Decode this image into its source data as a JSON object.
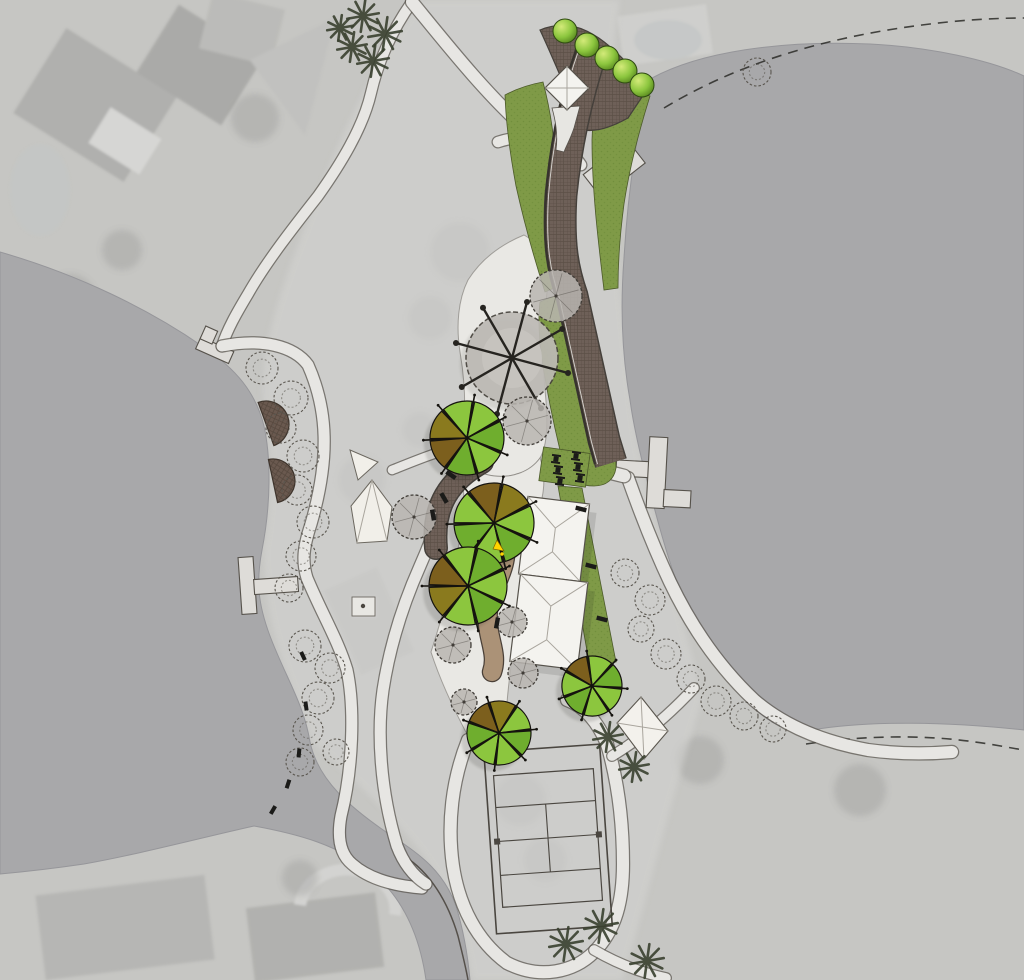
{
  "title": "lakeside-park-master-plan-aerial-overlay",
  "colors": {
    "land": "#c6c6c3",
    "parkLight": "#d3d3d0",
    "water": "#a8a8aa",
    "waterEdge": "#96969a",
    "pathFill": "#e7e6e3",
    "pathEdge": "#57524c",
    "apron": "#e9e8e4",
    "lawn": "#7f9a47",
    "lawnDot": "#718e3c",
    "promenade": "#6e6058",
    "promenadeLine": "#5c5047",
    "curb": "#37332e",
    "deck": "#6a594f",
    "deckLine": "#54463c",
    "tan": "#ab9277",
    "tanEdge": "#4a4038",
    "treeGreen": "#8cc63e",
    "treeGreen2": "#6fae2e",
    "treeOlive": "#8a7a1e",
    "treeBrown": "#7c5f1d",
    "treeOutline": "#15130f",
    "canopy": "#b8b5b0",
    "canopyEdge": "#413d38",
    "hedgeEdge": "#2f4a12",
    "building": "#f4f3ef",
    "buildingEdge": "#56524b",
    "ridge": "#a9a59d",
    "dock": "#dedcd8",
    "white": "#f1efe9",
    "palm": "#39402f",
    "black": "#1b1b19",
    "yellow": "#ffd400",
    "ghost": "#9a9a98"
  },
  "features": {
    "design_trees": [
      {
        "cx": 467,
        "cy": 438,
        "r": 37,
        "rot": 10,
        "c": [
          "g",
          "g2",
          "g",
          "g2",
          "b",
          "o",
          "g"
        ]
      },
      {
        "cx": 494,
        "cy": 523,
        "r": 40,
        "rot": -40,
        "c": [
          "b",
          "o",
          "g",
          "g2",
          "g",
          "g2",
          "g"
        ]
      },
      {
        "cx": 468,
        "cy": 586,
        "r": 39,
        "rot": -90,
        "c": [
          "b",
          "g",
          "g2",
          "g",
          "g2",
          "g",
          "o"
        ]
      },
      {
        "cx": 592,
        "cy": 686,
        "r": 30,
        "rot": -60,
        "c": [
          "b",
          "g",
          "g2",
          "g",
          "g",
          "g2",
          "g"
        ]
      },
      {
        "cx": 499,
        "cy": 733,
        "r": 32,
        "rot": -70,
        "c": [
          "b",
          "o",
          "g",
          "g2",
          "g",
          "g",
          "g2"
        ]
      }
    ],
    "hedge_trees": [
      {
        "cx": 565,
        "cy": 31,
        "r": 12
      },
      {
        "cx": 587,
        "cy": 45,
        "r": 12
      },
      {
        "cx": 607,
        "cy": 58,
        "r": 12
      },
      {
        "cx": 625,
        "cy": 71,
        "r": 12
      },
      {
        "cx": 642,
        "cy": 85,
        "r": 12
      }
    ],
    "gray_trees": [
      {
        "cx": 556,
        "cy": 296,
        "r": 26
      },
      {
        "cx": 527,
        "cy": 421,
        "r": 24
      },
      {
        "cx": 414,
        "cy": 517,
        "r": 22
      },
      {
        "cx": 512,
        "cy": 622,
        "r": 15
      },
      {
        "cx": 453,
        "cy": 645,
        "r": 18
      },
      {
        "cx": 523,
        "cy": 673,
        "r": 15
      },
      {
        "cx": 464,
        "cy": 702,
        "r": 13
      }
    ],
    "plaza": {
      "cx": 512,
      "cy": 358,
      "r": 46,
      "spoke_len": 58,
      "spoke_angles": [
        15,
        60,
        105,
        150,
        195,
        240,
        285,
        330
      ]
    },
    "palms": [
      {
        "cx": 363,
        "cy": 16,
        "r": 16
      },
      {
        "cx": 385,
        "cy": 34,
        "r": 17
      },
      {
        "cx": 352,
        "cy": 47,
        "r": 15
      },
      {
        "cx": 373,
        "cy": 61,
        "r": 16
      },
      {
        "cx": 340,
        "cy": 28,
        "r": 13
      },
      {
        "cx": 608,
        "cy": 737,
        "r": 15
      },
      {
        "cx": 634,
        "cy": 767,
        "r": 15
      },
      {
        "cx": 566,
        "cy": 944,
        "r": 17
      },
      {
        "cx": 601,
        "cy": 926,
        "r": 17
      },
      {
        "cx": 647,
        "cy": 961,
        "r": 17
      }
    ],
    "sketch_trees": [
      {
        "cx": 262,
        "cy": 368,
        "r": 16
      },
      {
        "cx": 291,
        "cy": 398,
        "r": 17
      },
      {
        "cx": 281,
        "cy": 428,
        "r": 15
      },
      {
        "cx": 303,
        "cy": 456,
        "r": 16
      },
      {
        "cx": 297,
        "cy": 490,
        "r": 15
      },
      {
        "cx": 313,
        "cy": 522,
        "r": 16
      },
      {
        "cx": 301,
        "cy": 556,
        "r": 15
      },
      {
        "cx": 289,
        "cy": 588,
        "r": 14
      },
      {
        "cx": 305,
        "cy": 646,
        "r": 16
      },
      {
        "cx": 330,
        "cy": 668,
        "r": 15
      },
      {
        "cx": 318,
        "cy": 698,
        "r": 16
      },
      {
        "cx": 308,
        "cy": 730,
        "r": 15
      },
      {
        "cx": 300,
        "cy": 762,
        "r": 14
      },
      {
        "cx": 336,
        "cy": 752,
        "r": 13
      },
      {
        "cx": 625,
        "cy": 573,
        "r": 14
      },
      {
        "cx": 650,
        "cy": 600,
        "r": 15
      },
      {
        "cx": 641,
        "cy": 629,
        "r": 13
      },
      {
        "cx": 666,
        "cy": 654,
        "r": 15
      },
      {
        "cx": 691,
        "cy": 679,
        "r": 14
      },
      {
        "cx": 716,
        "cy": 701,
        "r": 15
      },
      {
        "cx": 744,
        "cy": 716,
        "r": 14
      },
      {
        "cx": 773,
        "cy": 729,
        "r": 13
      },
      {
        "cx": 757,
        "cy": 72,
        "r": 14
      }
    ],
    "benches": [
      {
        "x": 581,
        "y": 509,
        "a": 14
      },
      {
        "x": 591,
        "y": 566,
        "a": 14
      },
      {
        "x": 602,
        "y": 619,
        "a": 14
      },
      {
        "x": 451,
        "y": 475,
        "a": 35
      },
      {
        "x": 433,
        "y": 515,
        "a": 80
      },
      {
        "x": 497,
        "y": 623,
        "a": 100
      },
      {
        "x": 444,
        "y": 498,
        "a": 60
      }
    ],
    "picnic_tables": [
      {
        "x": 556,
        "y": 459,
        "a": 8
      },
      {
        "x": 576,
        "y": 456,
        "a": 8
      },
      {
        "x": 558,
        "y": 470,
        "a": 8
      },
      {
        "x": 578,
        "y": 467,
        "a": 8
      },
      {
        "x": 560,
        "y": 481,
        "a": 8
      },
      {
        "x": 580,
        "y": 478,
        "a": 8
      }
    ],
    "shore_markers": [
      {
        "x": 303,
        "y": 656,
        "a": 65
      },
      {
        "x": 306,
        "y": 706,
        "a": 82
      },
      {
        "x": 299,
        "y": 753,
        "a": 95
      },
      {
        "x": 288,
        "y": 784,
        "a": 108
      },
      {
        "x": 273,
        "y": 810,
        "a": 120
      }
    ]
  }
}
